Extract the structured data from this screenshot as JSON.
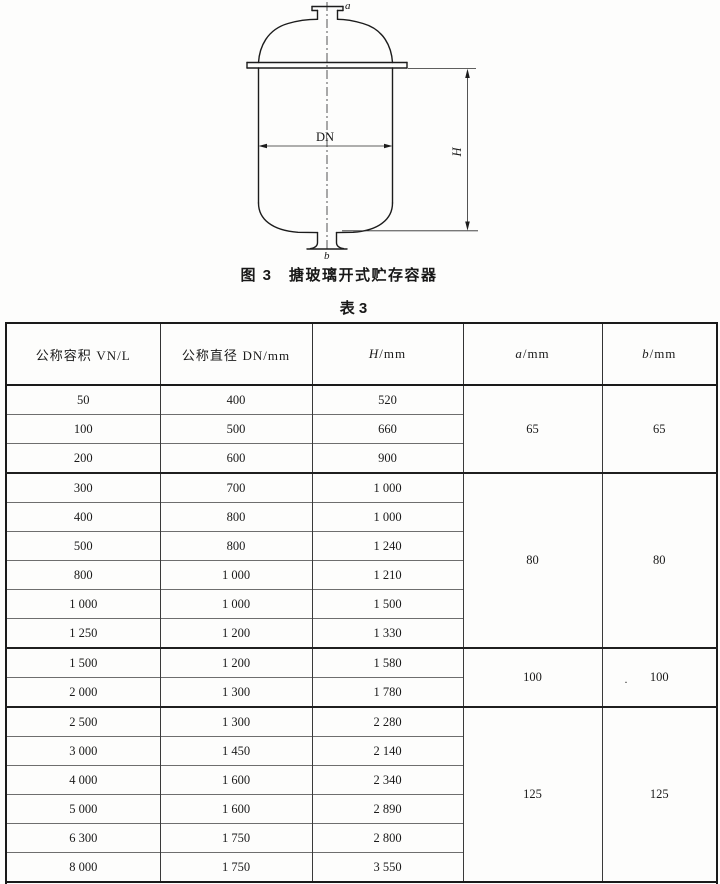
{
  "figure": {
    "caption": "图 3　搪玻璃开式贮存容器",
    "labels": {
      "top_nozzle": "a",
      "bottom_nozzle": "b",
      "diameter": "DN",
      "height": "H"
    }
  },
  "table": {
    "caption": "表 3",
    "headers": [
      {
        "seg": [
          {
            "t": "公称容积 "
          },
          {
            "t": "VN/L",
            "serif": true
          }
        ]
      },
      {
        "seg": [
          {
            "t": "公称直径 "
          },
          {
            "t": "DN/mm",
            "serif": true
          }
        ]
      },
      {
        "seg": [
          {
            "t": "H",
            "serif": true,
            "i": true
          },
          {
            "t": "/mm",
            "serif": true
          }
        ]
      },
      {
        "seg": [
          {
            "t": "a",
            "serif": true,
            "i": true
          },
          {
            "t": "/mm",
            "serif": true
          }
        ]
      },
      {
        "seg": [
          {
            "t": "b",
            "serif": true,
            "i": true
          },
          {
            "t": "/mm",
            "serif": true
          }
        ]
      }
    ],
    "groups": [
      {
        "a": "65",
        "b": "65",
        "rows": [
          [
            "50",
            "400",
            "520"
          ],
          [
            "100",
            "500",
            "660"
          ],
          [
            "200",
            "600",
            "900"
          ]
        ]
      },
      {
        "a": "80",
        "b": "80",
        "rows": [
          [
            "300",
            "700",
            "1 000"
          ],
          [
            "400",
            "800",
            "1 000"
          ],
          [
            "500",
            "800",
            "1 240"
          ],
          [
            "800",
            "1 000",
            "1 210"
          ],
          [
            "1 000",
            "1 000",
            "1 500"
          ],
          [
            "1 250",
            "1 200",
            "1 330"
          ]
        ]
      },
      {
        "a": "100",
        "b": "100",
        "b_stray_mark": ".",
        "rows": [
          [
            "1 500",
            "1 200",
            "1 580"
          ],
          [
            "2 000",
            "1 300",
            "1 780"
          ]
        ]
      },
      {
        "a": "125",
        "b": "125",
        "rows": [
          [
            "2 500",
            "1 300",
            "2 280"
          ],
          [
            "3 000",
            "1 450",
            "2 140"
          ],
          [
            "4 000",
            "1 600",
            "2 340"
          ],
          [
            "5 000",
            "1 600",
            "2 890"
          ],
          [
            "6 300",
            "1 750",
            "2 800"
          ],
          [
            "8 000",
            "1 750",
            "3 550"
          ]
        ]
      }
    ],
    "note_seg": [
      {
        "t": "注:表中的 "
      },
      {
        "t": "a",
        "serif": true,
        "i": true
      },
      {
        "t": "、"
      },
      {
        "t": "b",
        "serif": true,
        "i": true
      },
      {
        "t": " 为管口公称直径。"
      }
    ]
  }
}
